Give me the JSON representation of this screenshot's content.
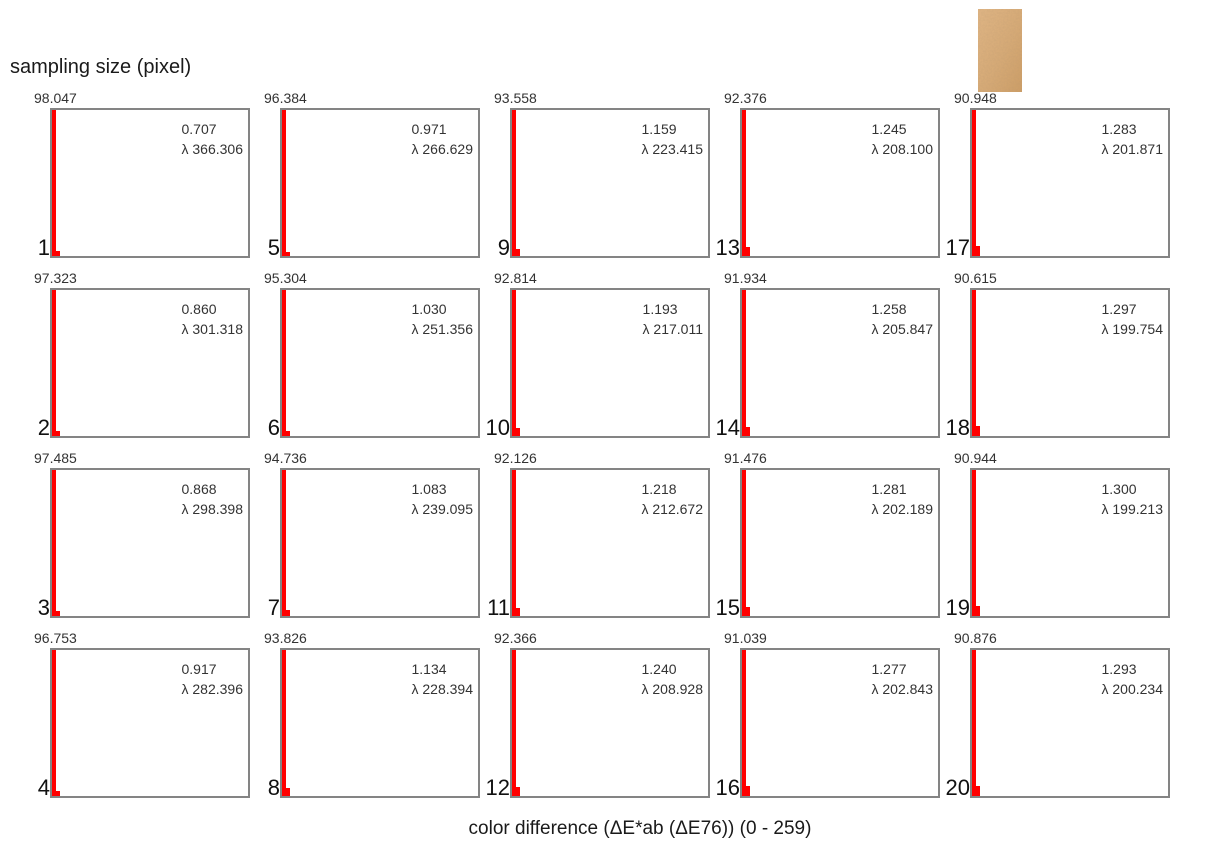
{
  "title": "sampling size (pixel)",
  "x_axis_label": "color difference (ΔE*ab (ΔE76)) (0 - 259)",
  "swatch": {
    "name": "skin-sample-image",
    "base_color": "#d9ac77"
  },
  "colors": {
    "bar": "#ff0000",
    "panel_border": "#848484",
    "text": "#333333"
  },
  "chart_data": {
    "type": "bar",
    "subtype": "histogram-small-multiples",
    "grid": {
      "rows": 4,
      "cols": 5,
      "numbering": "column-major, panels labeled 1-20 (sampling size in pixels)"
    },
    "xlabel": "color difference (ΔE*ab (ΔE76)) (0 - 259)",
    "x_range": [
      0,
      259
    ],
    "notes": "Each panel: first bin (red) clipped at full height with its percentage printed above the top-left corner; a small second bin at lower left; annotation shows mean ΔE value and fitted λ.",
    "panels": [
      {
        "id": "1",
        "peak": "98.047",
        "value": "0.707",
        "lambda": "λ 366.306",
        "bin2_px": 5
      },
      {
        "id": "2",
        "peak": "97.323",
        "value": "0.860",
        "lambda": "λ 301.318",
        "bin2_px": 5
      },
      {
        "id": "3",
        "peak": "97.485",
        "value": "0.868",
        "lambda": "λ 298.398",
        "bin2_px": 5
      },
      {
        "id": "4",
        "peak": "96.753",
        "value": "0.917",
        "lambda": "λ 282.396",
        "bin2_px": 5
      },
      {
        "id": "5",
        "peak": "96.384",
        "value": "0.971",
        "lambda": "λ 266.629",
        "bin2_px": 4
      },
      {
        "id": "6",
        "peak": "95.304",
        "value": "1.030",
        "lambda": "λ 251.356",
        "bin2_px": 5
      },
      {
        "id": "7",
        "peak": "94.736",
        "value": "1.083",
        "lambda": "λ 239.095",
        "bin2_px": 6
      },
      {
        "id": "8",
        "peak": "93.826",
        "value": "1.134",
        "lambda": "λ 228.394",
        "bin2_px": 8
      },
      {
        "id": "9",
        "peak": "93.558",
        "value": "1.159",
        "lambda": "λ 223.415",
        "bin2_px": 7
      },
      {
        "id": "10",
        "peak": "92.814",
        "value": "1.193",
        "lambda": "λ 217.011",
        "bin2_px": 8
      },
      {
        "id": "11",
        "peak": "92.126",
        "value": "1.218",
        "lambda": "λ 212.672",
        "bin2_px": 8
      },
      {
        "id": "12",
        "peak": "92.366",
        "value": "1.240",
        "lambda": "λ 208.928",
        "bin2_px": 9
      },
      {
        "id": "13",
        "peak": "92.376",
        "value": "1.245",
        "lambda": "λ 208.100",
        "bin2_px": 9
      },
      {
        "id": "14",
        "peak": "91.934",
        "value": "1.258",
        "lambda": "λ 205.847",
        "bin2_px": 9
      },
      {
        "id": "15",
        "peak": "91.476",
        "value": "1.281",
        "lambda": "λ 202.189",
        "bin2_px": 9
      },
      {
        "id": "16",
        "peak": "91.039",
        "value": "1.277",
        "lambda": "λ 202.843",
        "bin2_px": 10
      },
      {
        "id": "17",
        "peak": "90.948",
        "value": "1.283",
        "lambda": "λ 201.871",
        "bin2_px": 10
      },
      {
        "id": "18",
        "peak": "90.615",
        "value": "1.297",
        "lambda": "λ 199.754",
        "bin2_px": 10
      },
      {
        "id": "19",
        "peak": "90.944",
        "value": "1.300",
        "lambda": "λ 199.213",
        "bin2_px": 10
      },
      {
        "id": "20",
        "peak": "90.876",
        "value": "1.293",
        "lambda": "λ 200.234",
        "bin2_px": 10
      }
    ]
  }
}
